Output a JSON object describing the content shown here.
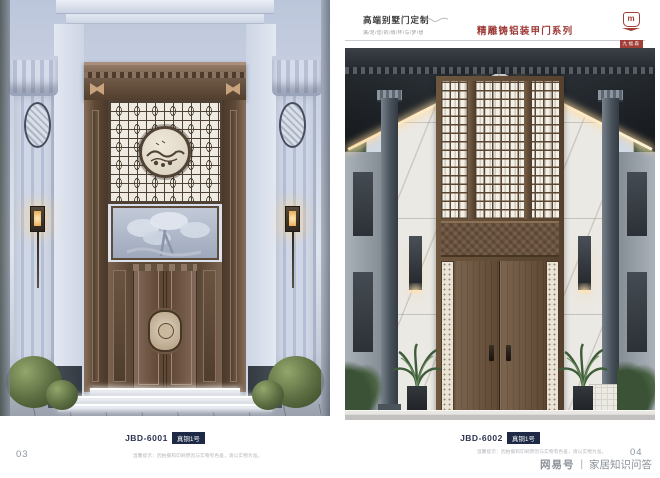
{
  "header": {
    "series_title": "高端别墅门定制",
    "series_subtitle": "满/足/您/的/情/怀/与/梦/想",
    "collection_title": "精雕铸铝装甲门系列",
    "collection_color": "#9c3a37",
    "logo": {
      "glyph": "m",
      "name": "九福森"
    }
  },
  "panels": [
    {
      "code": "JBD-6001",
      "badge": "真铜1号"
    },
    {
      "code": "JBD-6002",
      "badge": "真铜1号"
    }
  ],
  "footer": {
    "page_left": "03",
    "page_right": "04",
    "disclaimer": "温馨提示：因拍摄和印刷原因与实物有色差，请以实物为准。",
    "watermark": {
      "brand": "网易号",
      "separator": "丨",
      "label": "家居知识问答"
    }
  },
  "colors": {
    "badge_bg": "#1d2945",
    "code_text": "#2b3551",
    "bronze": "#5d4936",
    "accent_red": "#9c3a37"
  }
}
